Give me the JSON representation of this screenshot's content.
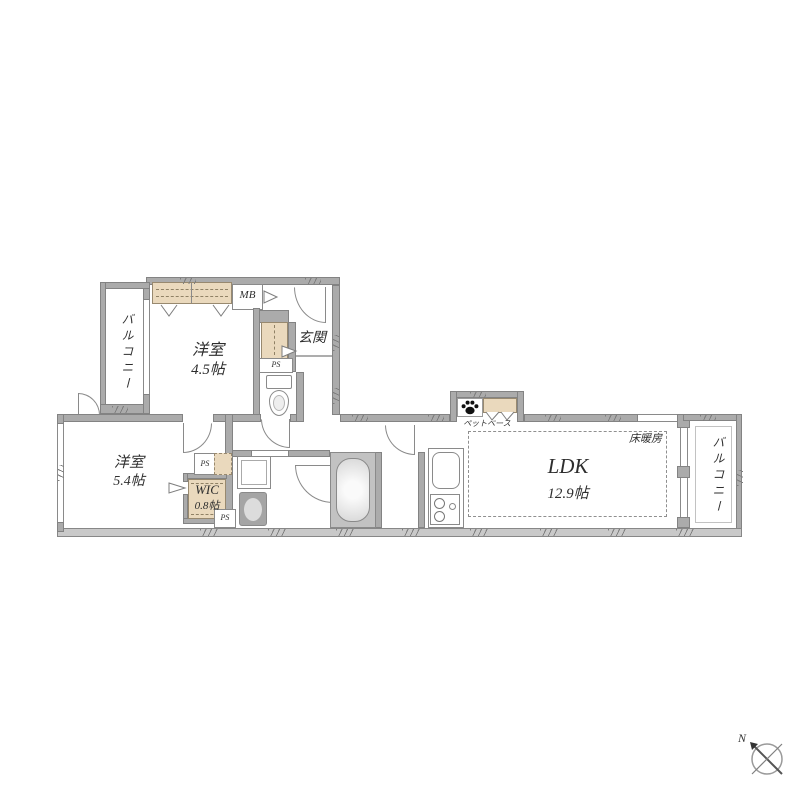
{
  "labels": {
    "balcony_left": "バルコニー",
    "balcony_right": "バルコニー",
    "room_a_name": "洋室",
    "room_a_size": "4.5帖",
    "room_b_name": "洋室",
    "room_b_size": "5.4帖",
    "wic_name": "WIC",
    "wic_size": "0.8帖",
    "ldk_name": "LDK",
    "ldk_size": "12.9帖",
    "entrance": "玄関",
    "meter_box": "MB",
    "pipe_space_entrance": "PS",
    "pipe_space_upper": "PS",
    "pipe_space_lower": "PS",
    "floor_heating": "床暖房",
    "pet_space": "ペットベース",
    "compass_north": "N"
  },
  "colors": {
    "wall": "#ababab",
    "closet_fill": "#ead9bd",
    "line": "#8a8a8a",
    "background": "#ffffff"
  }
}
